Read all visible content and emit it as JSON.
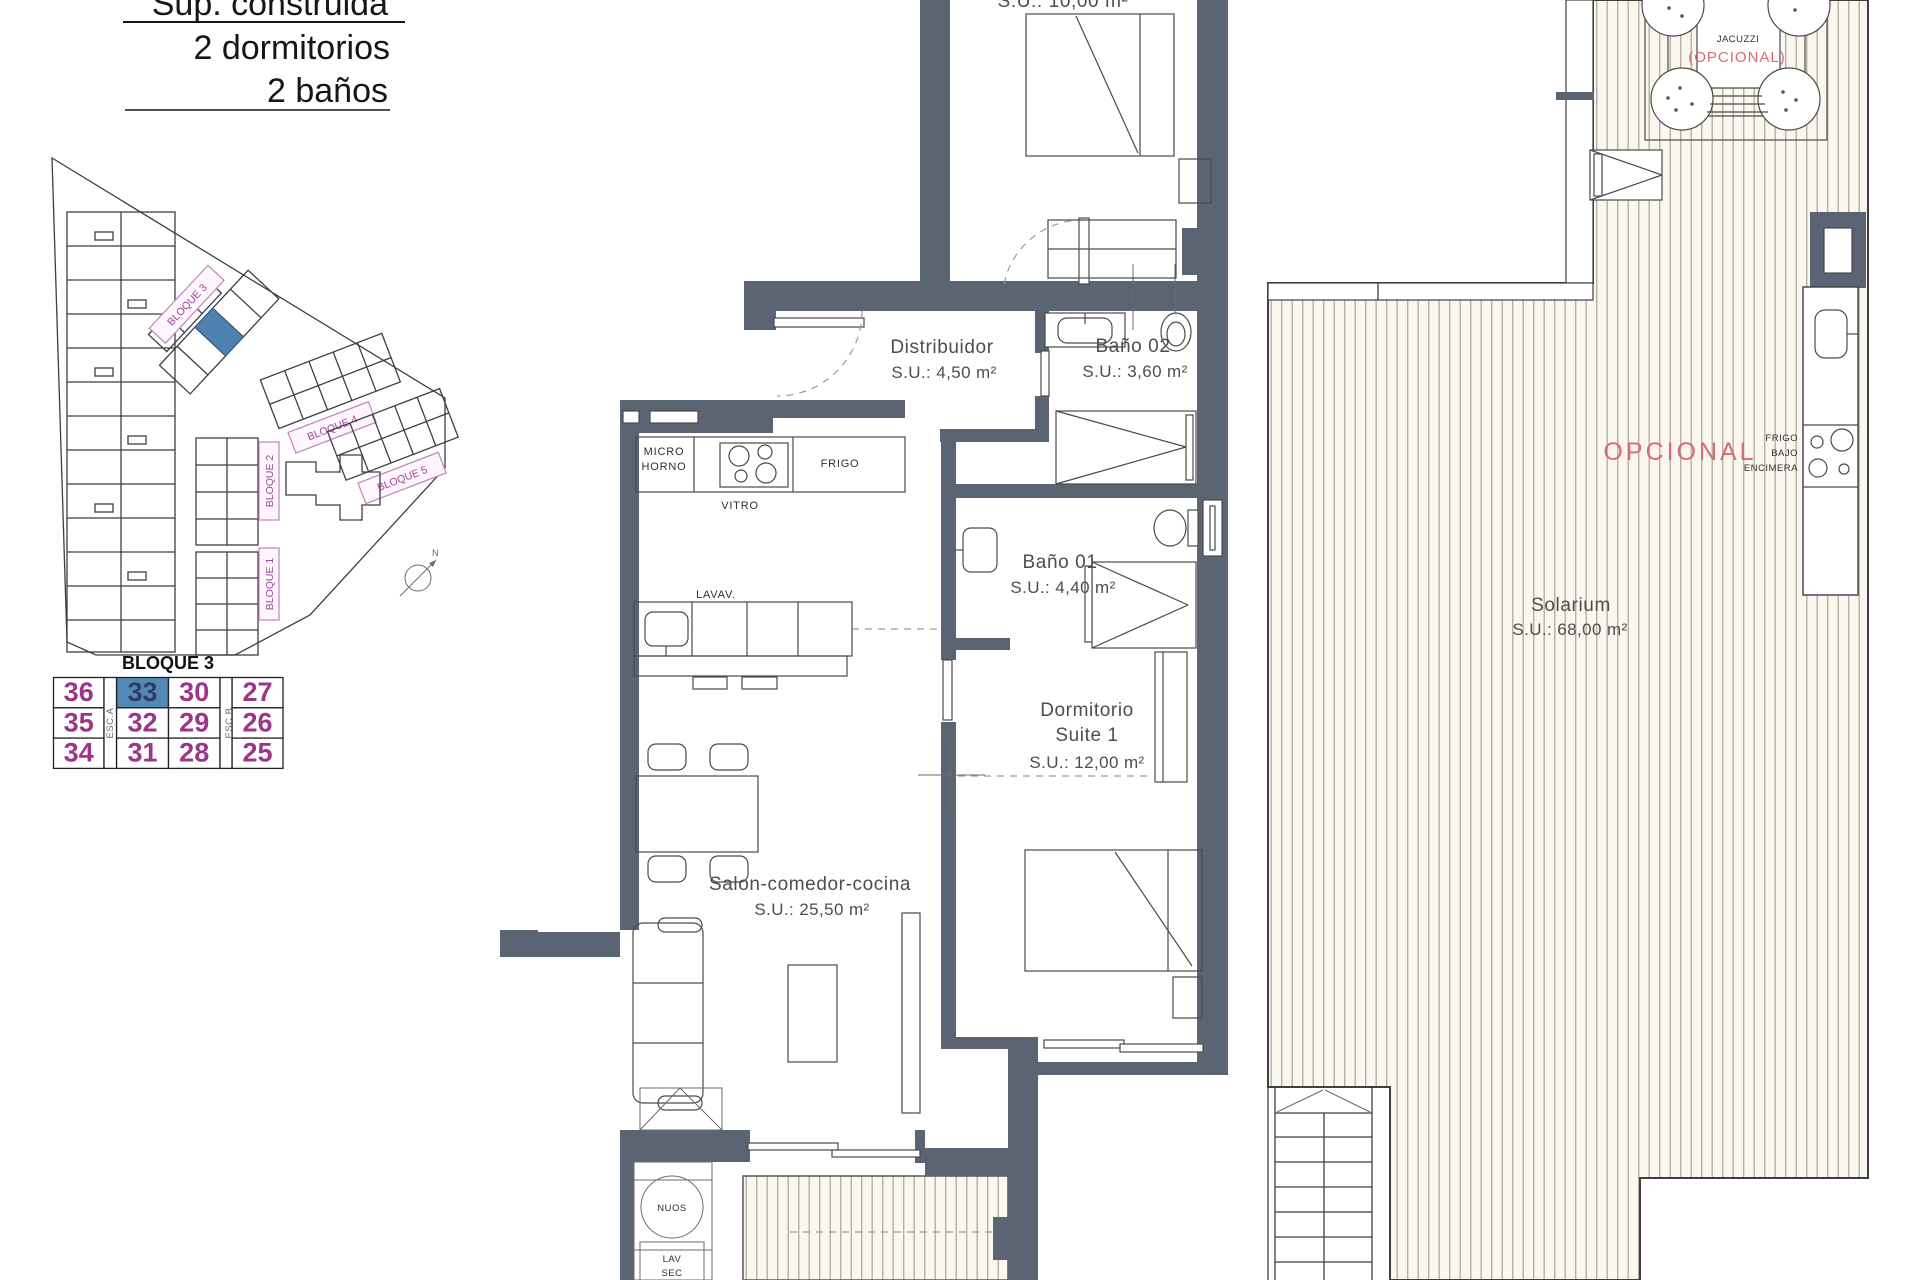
{
  "header": {
    "title_line": "Sup. construida",
    "bedrooms": "2 dormitorios",
    "bathrooms": "2 baños"
  },
  "site_plan": {
    "block_labels": [
      "BLOQUE 3",
      "BLOQUE 4",
      "BLOQUE 5",
      "BLOQUE 2",
      "BLOQUE 1"
    ],
    "north_label": "N",
    "highlight_color": "#4e81ad"
  },
  "unit_table": {
    "title": "BLOQUE 3",
    "stair_a": "ESC.A",
    "stair_b": "ESC.B",
    "selected_unit": "33",
    "selected_bg": "#5389b7",
    "number_color": "#9c3587",
    "cells": [
      "36",
      "33",
      "30",
      "27",
      "35",
      "32",
      "29",
      "26",
      "34",
      "31",
      "28",
      "25"
    ]
  },
  "main_plan": {
    "top_room_area": "S.U.: 10,00 m²",
    "distribuidor": {
      "name": "Distribuidor",
      "area": "S.U.: 4,50 m²"
    },
    "bano02": {
      "name": "Baño 02",
      "area": "S.U.: 3,60 m²"
    },
    "bano01": {
      "name": "Baño 01",
      "area": "S.U.: 4,40 m²"
    },
    "suite": {
      "name_line1": "Dormitorio",
      "name_line2": "Suite 1",
      "area": "S.U.: 12,00 m²"
    },
    "salon": {
      "name": "Salon-comedor-cocina",
      "area": "S.U.: 25,50 m²"
    },
    "kitchen": {
      "micro_line1": "MICRO",
      "micro_line2": "HORNO",
      "vitro": "VITRO",
      "frigo": "FRIGO",
      "lavav": "LAVAV."
    },
    "utility": {
      "nuos": "NUOS",
      "lav": "LAV",
      "sec": "SEC"
    }
  },
  "solarium_plan": {
    "solarium": {
      "name": "Solarium",
      "area": "S.U.: 68,00 m²"
    },
    "jacuzzi": {
      "name": "JACUZZI",
      "optional": "(OPCIONAL)"
    },
    "opcional": "OPCIONAL",
    "bbq": {
      "line1": "FRIGO",
      "line2": "BAJO",
      "line3": "ENCIMERA"
    }
  },
  "colors": {
    "wall": "#5a6472",
    "deck_bg": "#f9f7f0",
    "deck_line": "#b8b09c",
    "accent_red": "#d96b75"
  }
}
